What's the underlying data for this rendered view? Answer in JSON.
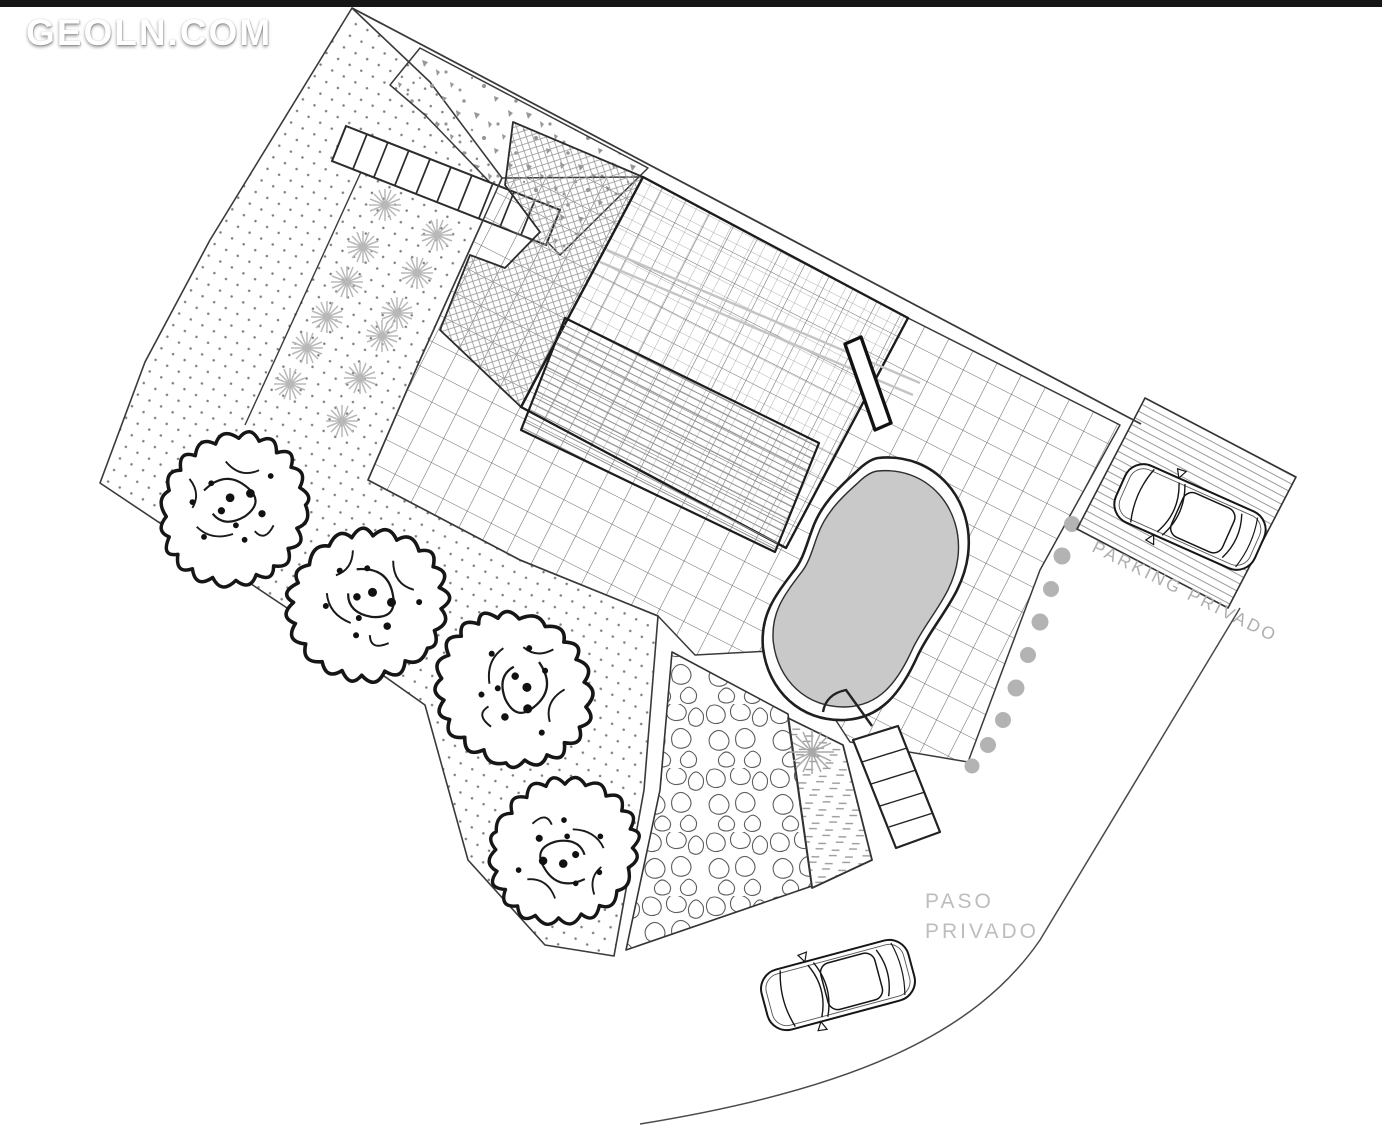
{
  "page": {
    "top_bar_color": "#161616",
    "background": "#ffffff"
  },
  "watermark": {
    "text": "GEOLN.COM"
  },
  "plan": {
    "labels": {
      "parking": "PARKING PRIVADO",
      "road_line1": "PASO",
      "road_line2": "PRIVADO"
    },
    "colors": {
      "pool_water": "#c9c9c9",
      "pool_edge": "#2a2a2a",
      "line": "#3a3a3a",
      "thick_line": "#1c1c1c",
      "label_gray": "#aeaeae",
      "road_label_gray": "#bdbdbd",
      "hedge_shrub": "#b3b3b3",
      "ornamental_tree": "#b8b8b8",
      "palm": "#a8a8a8"
    },
    "counts": {
      "large_trees": 4,
      "ornamental_trees": 12,
      "hedge_shrubs": 9,
      "cars": 2
    }
  }
}
